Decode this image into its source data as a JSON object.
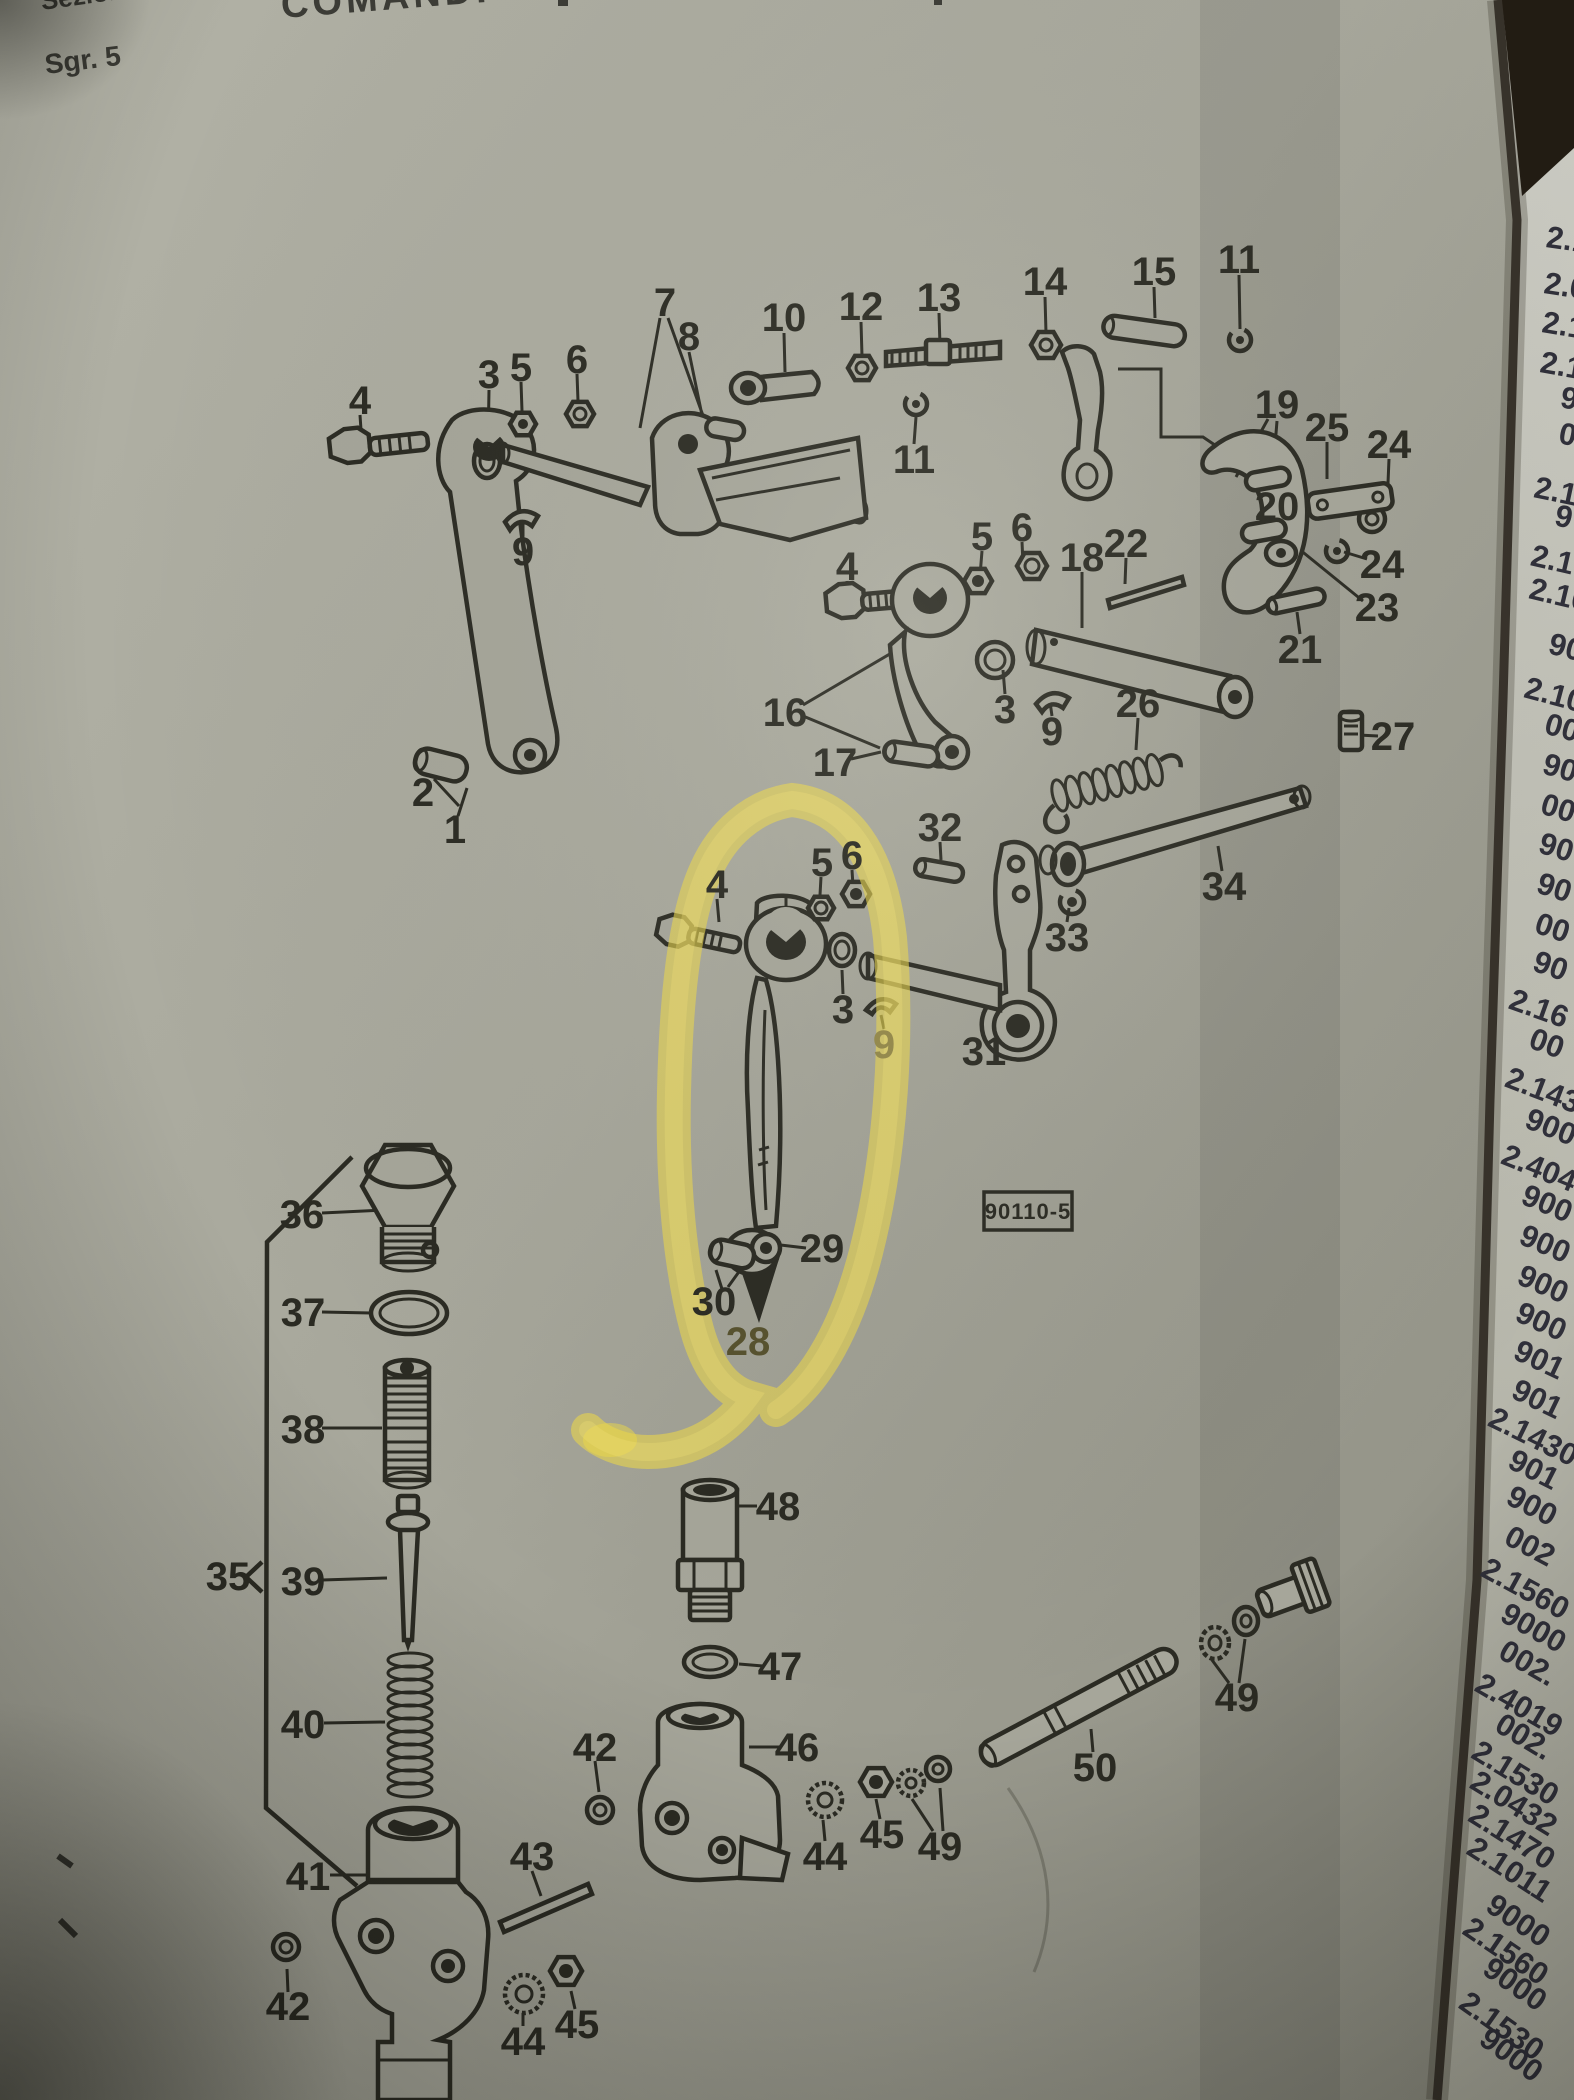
{
  "header": {
    "section": "Sezione",
    "subgroup": "Sgr. 5",
    "title": "COMANDI"
  },
  "stamp": {
    "code": "90110-5"
  },
  "colors": {
    "paper": "#a6a69a",
    "ink": "#2b2b23",
    "highlighter": "#f0db46",
    "next_page": "#c9c9c0",
    "photo_background": "#1d1813"
  },
  "diagram": {
    "description_note": "exploded parts diagram with numbered callouts",
    "highlighted_parts": [
      "28",
      "29",
      "30"
    ],
    "callouts": [
      {
        "n": "4",
        "x": 360,
        "y": 400
      },
      {
        "n": "3",
        "x": 489,
        "y": 374
      },
      {
        "n": "5",
        "x": 521,
        "y": 367
      },
      {
        "n": "6",
        "x": 577,
        "y": 359
      },
      {
        "n": "7",
        "x": 665,
        "y": 302
      },
      {
        "n": "8",
        "x": 689,
        "y": 336
      },
      {
        "n": "10",
        "x": 784,
        "y": 317
      },
      {
        "n": "12",
        "x": 861,
        "y": 306
      },
      {
        "n": "13",
        "x": 939,
        "y": 297
      },
      {
        "n": "11",
        "x": 914,
        "y": 459
      },
      {
        "n": "14",
        "x": 1045,
        "y": 281
      },
      {
        "n": "15",
        "x": 1154,
        "y": 271
      },
      {
        "n": "11",
        "x": 1239,
        "y": 259
      },
      {
        "n": "9",
        "x": 523,
        "y": 551
      },
      {
        "n": "2",
        "x": 423,
        "y": 792
      },
      {
        "n": "1",
        "x": 455,
        "y": 829
      },
      {
        "n": "19",
        "x": 1277,
        "y": 404
      },
      {
        "n": "25",
        "x": 1327,
        "y": 427
      },
      {
        "n": "24",
        "x": 1389,
        "y": 444
      },
      {
        "n": "20",
        "x": 1277,
        "y": 506
      },
      {
        "n": "24",
        "x": 1382,
        "y": 564
      },
      {
        "n": "23",
        "x": 1377,
        "y": 607
      },
      {
        "n": "21",
        "x": 1300,
        "y": 649
      },
      {
        "n": "22",
        "x": 1126,
        "y": 543
      },
      {
        "n": "18",
        "x": 1082,
        "y": 557
      },
      {
        "n": "4",
        "x": 847,
        "y": 566
      },
      {
        "n": "5",
        "x": 982,
        "y": 536
      },
      {
        "n": "6",
        "x": 1022,
        "y": 527
      },
      {
        "n": "3",
        "x": 1005,
        "y": 709
      },
      {
        "n": "9",
        "x": 1052,
        "y": 731
      },
      {
        "n": "16",
        "x": 785,
        "y": 712
      },
      {
        "n": "17",
        "x": 835,
        "y": 762
      },
      {
        "n": "26",
        "x": 1138,
        "y": 703
      },
      {
        "n": "27",
        "x": 1393,
        "y": 736
      },
      {
        "n": "32",
        "x": 940,
        "y": 827
      },
      {
        "n": "33",
        "x": 1067,
        "y": 937
      },
      {
        "n": "34",
        "x": 1224,
        "y": 886
      },
      {
        "n": "31",
        "x": 984,
        "y": 1051
      },
      {
        "n": "4",
        "x": 717,
        "y": 884
      },
      {
        "n": "5",
        "x": 822,
        "y": 862
      },
      {
        "n": "6",
        "x": 852,
        "y": 855
      },
      {
        "n": "3",
        "x": 843,
        "y": 1009
      },
      {
        "n": "9",
        "x": 884,
        "y": 1044,
        "cls": "faded"
      },
      {
        "n": "29",
        "x": 822,
        "y": 1248
      },
      {
        "n": "30",
        "x": 714,
        "y": 1301
      },
      {
        "n": "28",
        "x": 748,
        "y": 1341,
        "cls": "dim"
      },
      {
        "n": "36",
        "x": 302,
        "y": 1214
      },
      {
        "n": "37",
        "x": 303,
        "y": 1312
      },
      {
        "n": "38",
        "x": 303,
        "y": 1429
      },
      {
        "n": "35",
        "x": 228,
        "y": 1576
      },
      {
        "n": "39",
        "x": 303,
        "y": 1581
      },
      {
        "n": "40",
        "x": 303,
        "y": 1724
      },
      {
        "n": "41",
        "x": 308,
        "y": 1876
      },
      {
        "n": "42",
        "x": 595,
        "y": 1747
      },
      {
        "n": "43",
        "x": 532,
        "y": 1856
      },
      {
        "n": "42",
        "x": 288,
        "y": 2006
      },
      {
        "n": "44",
        "x": 523,
        "y": 2041
      },
      {
        "n": "45",
        "x": 577,
        "y": 2024
      },
      {
        "n": "48",
        "x": 778,
        "y": 1506
      },
      {
        "n": "47",
        "x": 780,
        "y": 1666
      },
      {
        "n": "46",
        "x": 797,
        "y": 1747
      },
      {
        "n": "44",
        "x": 825,
        "y": 1856
      },
      {
        "n": "45",
        "x": 882,
        "y": 1834
      },
      {
        "n": "49",
        "x": 940,
        "y": 1846
      },
      {
        "n": "50",
        "x": 1095,
        "y": 1767
      },
      {
        "n": "49",
        "x": 1237,
        "y": 1697
      }
    ]
  },
  "edge_page": {
    "note": "partial part numbers visible on edge of next catalog page",
    "numbers": [
      {
        "t": "2.1",
        "y": 247
      },
      {
        "t": "2.0",
        "y": 293
      },
      {
        "t": "2.1",
        "y": 332
      },
      {
        "t": "2.1",
        "y": 372
      },
      {
        "t": "9",
        "y": 407
      },
      {
        "t": "0",
        "y": 443
      },
      {
        "t": "2.1",
        "y": 497
      },
      {
        "t": "9",
        "y": 525
      },
      {
        "t": "2.1",
        "y": 565
      },
      {
        "t": "2.10",
        "y": 598
      },
      {
        "t": "90",
        "y": 653
      },
      {
        "t": "2.10",
        "y": 697
      },
      {
        "t": "00",
        "y": 733
      },
      {
        "t": "90",
        "y": 773
      },
      {
        "t": "00",
        "y": 813
      },
      {
        "t": "90",
        "y": 852
      },
      {
        "t": "90",
        "y": 892
      },
      {
        "t": "00",
        "y": 932
      },
      {
        "t": "90",
        "y": 970
      },
      {
        "t": "2.16",
        "y": 1008
      },
      {
        "t": "00",
        "y": 1047
      },
      {
        "t": "2.143",
        "y": 1086
      },
      {
        "t": "900",
        "y": 1127
      },
      {
        "t": "2.404",
        "y": 1163
      },
      {
        "t": "900",
        "y": 1203
      },
      {
        "t": "900",
        "y": 1243
      },
      {
        "t": "900",
        "y": 1283
      },
      {
        "t": "900",
        "y": 1320
      },
      {
        "t": "901",
        "y": 1358
      },
      {
        "t": "901",
        "y": 1397
      },
      {
        "t": "2.1430",
        "y": 1425
      },
      {
        "t": "901",
        "y": 1467
      },
      {
        "t": "900",
        "y": 1503
      },
      {
        "t": "002",
        "y": 1543
      },
      {
        "t": "2.1560",
        "y": 1575
      },
      {
        "t": "9000",
        "y": 1620
      },
      {
        "t": "002.",
        "y": 1657
      },
      {
        "t": "2.4019",
        "y": 1690
      },
      {
        "t": "002.",
        "y": 1730
      },
      {
        "t": "2.1530",
        "y": 1757
      },
      {
        "t": "2.0432",
        "y": 1787
      },
      {
        "t": "2.1470",
        "y": 1820
      },
      {
        "t": "2.1011",
        "y": 1853
      },
      {
        "t": "9000",
        "y": 1910
      },
      {
        "t": "2.1560",
        "y": 1933
      },
      {
        "t": "9000",
        "y": 1973
      },
      {
        "t": "2.1530",
        "y": 2007
      },
      {
        "t": "9000",
        "y": 2043
      }
    ]
  }
}
